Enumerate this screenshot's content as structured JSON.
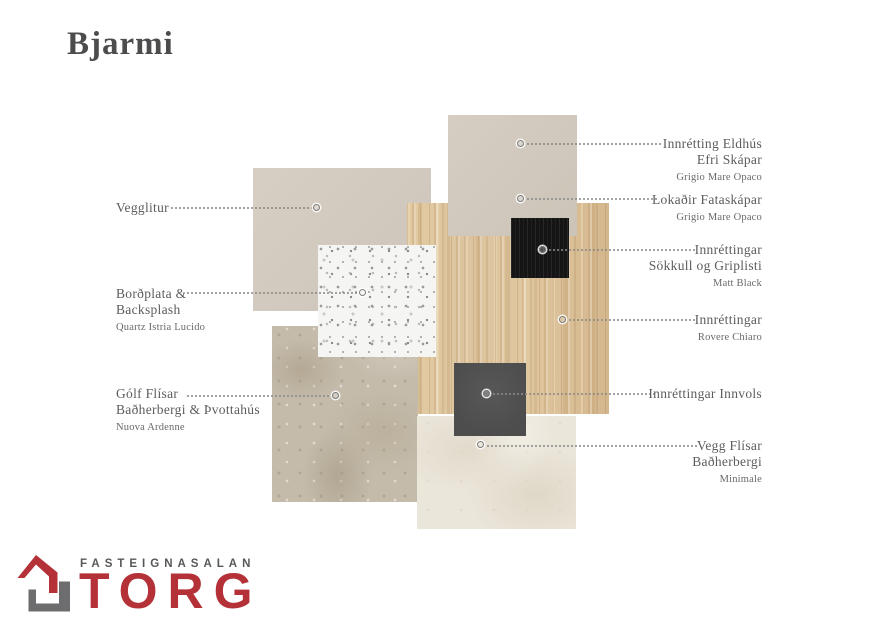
{
  "title": "Bjarmi",
  "swatches": {
    "vegglitur": {
      "name": "Vegglitur wall paint",
      "color": "#d4cbbf"
    },
    "efri_skapar": {
      "name": "Efri Skápar — Grigio Mare Opaco",
      "color": "#d3cabe"
    },
    "wood": {
      "name": "Innréttingar — Rovere Chiaro",
      "color": "#dcc49e"
    },
    "matt_black": {
      "name": "Sökkull og Griplisti — Matt Black",
      "color": "#151515"
    },
    "quartz": {
      "name": "Quartz Istria Lucido",
      "color": "#f5f5f3"
    },
    "stone": {
      "name": "Gólf flísar — Nuova Ardenne",
      "color": "#c4bbab"
    },
    "innvols": {
      "name": "Innréttingar Innvols",
      "color": "#4d4d4e"
    },
    "vegg_flisar": {
      "name": "Vegg flísar — Minimale",
      "color": "#ebe6da"
    }
  },
  "callouts": {
    "left": [
      {
        "line1": "Vegglitur",
        "line2": "",
        "sub": ""
      },
      {
        "line1": "Borðplata &",
        "line2": "Backsplash",
        "sub": "Quartz Istria Lucido"
      },
      {
        "line1": "Gólf Flísar",
        "line2": "Baðherbergi & Þvottahús",
        "sub": "Nuova Ardenne"
      }
    ],
    "right": [
      {
        "line1": "Innrétting Eldhús",
        "line2": "Efri Skápar",
        "sub": "Grigio Mare Opaco"
      },
      {
        "line1": "Lokaðir Fataskápar",
        "line2": "",
        "sub": "Grigio Mare Opaco"
      },
      {
        "line1": "Innréttingar",
        "line2": "Sökkull og Griplisti",
        "sub": "Matt Black"
      },
      {
        "line1": "Innréttingar",
        "line2": "",
        "sub": "Rovere Chiaro"
      },
      {
        "line1": "Innréttingar Innvols",
        "line2": "",
        "sub": ""
      },
      {
        "line1": "Vegg Flísar",
        "line2": "Baðherbergi",
        "sub": "Minimale"
      }
    ]
  },
  "logo": {
    "brand_top": "FASTEIGNASALAN",
    "brand_name": "TORG",
    "red": "#b43137",
    "gray": "#6d6d6f"
  }
}
